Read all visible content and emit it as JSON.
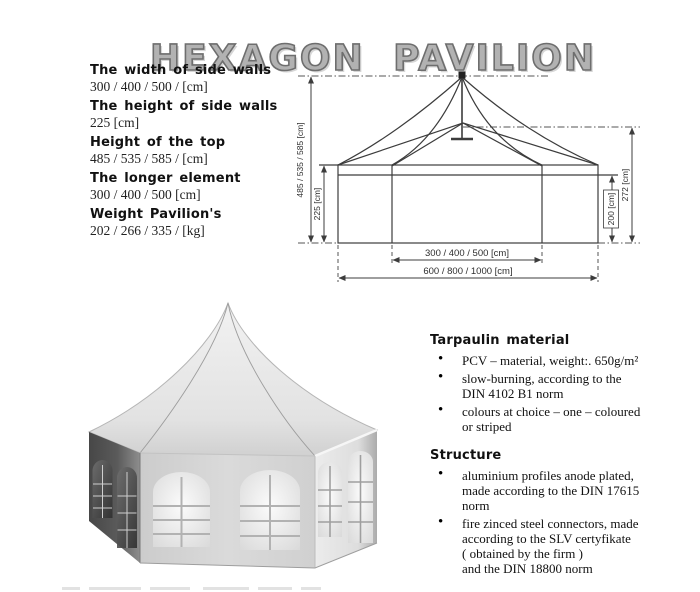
{
  "title": "HEXAGON PAVILION",
  "specs": [
    {
      "label": "The width of side walls",
      "value": "300 / 400 / 500 /  [cm]"
    },
    {
      "label": "The height of side walls",
      "value": "225 [cm]"
    },
    {
      "label": "Height of the top",
      "value": "485 / 535 / 585 /  [cm]"
    },
    {
      "label": "The longer element",
      "value": "300 / 400 / 500 [cm]"
    },
    {
      "label": "Weight Pavilion's",
      "value": "202 / 266 / 335 /  [kg]"
    }
  ],
  "diagram": {
    "height_total": "485 / 535 / 585 [cm]",
    "height_walls": "225 [cm]",
    "height_eave": "200 [cm]",
    "height_frame": "272 [cm]",
    "width_inner": "300 / 400 / 500 [cm]",
    "width_total": "600 / 800 / 1000 [cm]"
  },
  "sections": {
    "tarpaulin": {
      "heading": "Tarpaulin material",
      "bullets": [
        "PCV – material, weight:. 650g/m²",
        "slow-burning, according to the\nDIN 4102 B1 norm",
        "colours at choice – one – coloured\nor striped"
      ]
    },
    "structure": {
      "heading": "Structure",
      "bullets": [
        "aluminium profiles anode plated,\nmade according to the  DIN 17615\nnorm",
        "fire zinced steel connectors, made\naccording to the SLV certyfikate\n( obtained by the firm )\nand the DIN 18800 norm"
      ]
    }
  }
}
